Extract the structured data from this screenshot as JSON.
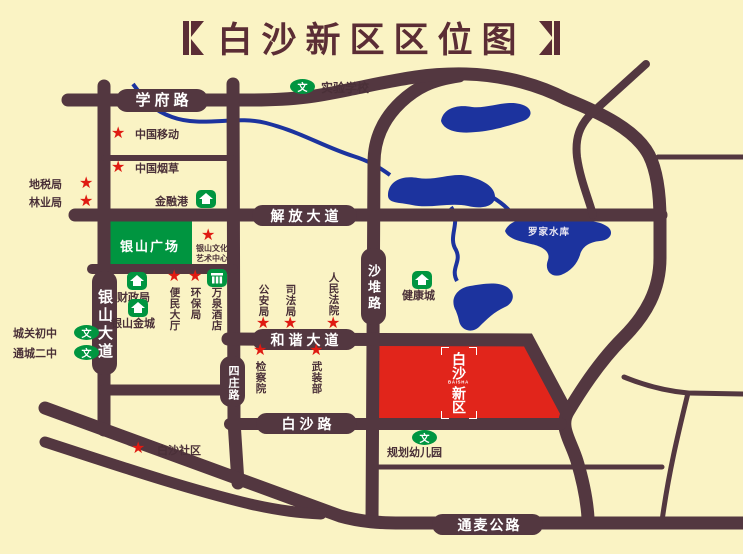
{
  "title": {
    "text": "白沙新区区位图"
  },
  "colors": {
    "background": "#FAF3C4",
    "road": "#533740",
    "title": "#5B2D35",
    "water": "#1C339E",
    "green": "#009540",
    "poi_text": "#4A3038",
    "star_red": "#DF1B12",
    "district_red": "#E1251B"
  },
  "map": {
    "road_labels": {
      "xuefu_lu": "学府路",
      "jiefang_dadao": "解放大道",
      "hexie_dadao": "和谐大道",
      "baisha_lu": "白沙路",
      "tongmai_gonglu": "通麦公路",
      "yinshan_dadao": "银山大道",
      "shadui_lu": "沙堆路",
      "sizhuang_lu": "四庄路"
    },
    "areas": {
      "yinshan_plaza": "银山广场",
      "luojia_reservoir": "罗家水库",
      "district_logo": {
        "top": "白沙",
        "latin": "BAISHA",
        "bottom": "新区"
      }
    },
    "star_pois": {
      "zhongguo_yidong": "中国移动",
      "zhongguo_yancao": "中国烟草",
      "dishuiju": "地税局",
      "linyeju": "林业局",
      "wenhua_line1": "银山文化",
      "wenhua_line2": "艺术中心",
      "bianmin_dating": "便民大厅",
      "huanbaoju": "环保局",
      "gonganju": "公安局",
      "sifaju": "司法局",
      "renmin_fayuan": "人民法院",
      "jianchayuan": "检察院",
      "wuzhuangbu": "武装部",
      "baisha_shequ": "白沙社区"
    },
    "house_pois": {
      "jinronggang": "金融港",
      "caizhengju": "财政局",
      "yinshan_jincheng": "银山金城",
      "jiankangcheng": "健康城",
      "wanquan_jiudian": "万泉酒店"
    },
    "school_pois": {
      "shiyan_xuexiao": "实验学校",
      "chengguan_chuzhong": "城关初中",
      "tongcheng_erzhong": "通城二中",
      "guihua_youeryuan": "规划幼儿园"
    },
    "icons": {
      "school_badge_glyph": "文",
      "star_glyph": "★"
    }
  }
}
